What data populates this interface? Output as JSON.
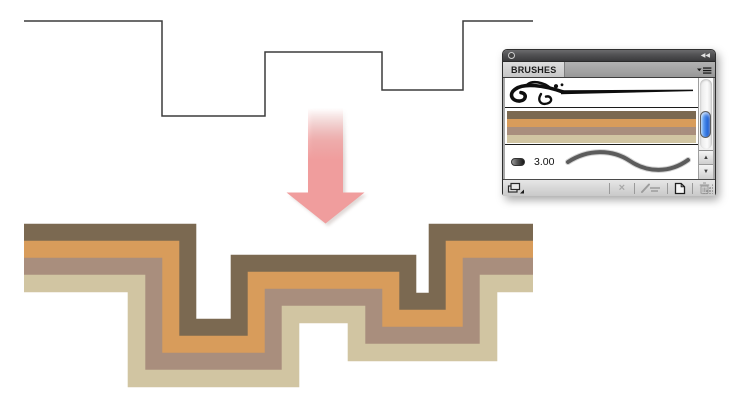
{
  "app": {
    "background": "#ffffff"
  },
  "drawing": {
    "thin_path": {
      "points": [
        [
          24,
          21
        ],
        [
          162,
          21
        ],
        [
          162,
          116
        ],
        [
          265,
          116
        ],
        [
          265,
          52
        ],
        [
          382,
          52
        ],
        [
          382,
          90
        ],
        [
          463,
          90
        ],
        [
          463,
          21
        ],
        [
          533,
          21
        ]
      ],
      "color": "#3c3c3c",
      "width": 1.5
    },
    "ribbon": {
      "offset_y": 237,
      "stripe_width": 17.6,
      "stripes": [
        {
          "name": "dark-brown",
          "color": "#7b6951",
          "offset": 25.5
        },
        {
          "name": "orange",
          "color": "#d89c5b",
          "offset": 8.5
        },
        {
          "name": "rosy-taupe",
          "color": "#a98e7d",
          "offset": -8.5
        },
        {
          "name": "cream",
          "color": "#d1c5a2",
          "offset": -25.5
        }
      ]
    },
    "arrow": {
      "color": "#f09d9d",
      "shadow_color": "#b9a9a4",
      "center_x": 325.5,
      "shaft_half_width": 17.5,
      "shaft_top_y": 108,
      "head_top_y": 192.5,
      "head_half_width": 39,
      "tip_y": 223.5
    }
  },
  "panel": {
    "title": "BRUSHES",
    "titlebar": {
      "collapse_icon": "◀◀"
    },
    "brushes": [
      {
        "name": "floral-art-brush",
        "type": "art"
      },
      {
        "name": "stripes-pattern-brush",
        "type": "pattern",
        "colors": [
          "#7b6951",
          "#d89c5b",
          "#a98e7d",
          "#d1c5a2"
        ]
      },
      {
        "name": "calligraphic-brush",
        "type": "calligraphic",
        "size_label": "3.00"
      }
    ],
    "scrollbar": {
      "up_icon": "▲",
      "down_icon": "▼"
    },
    "toolbar": {
      "remove_icon_char": "×"
    }
  }
}
